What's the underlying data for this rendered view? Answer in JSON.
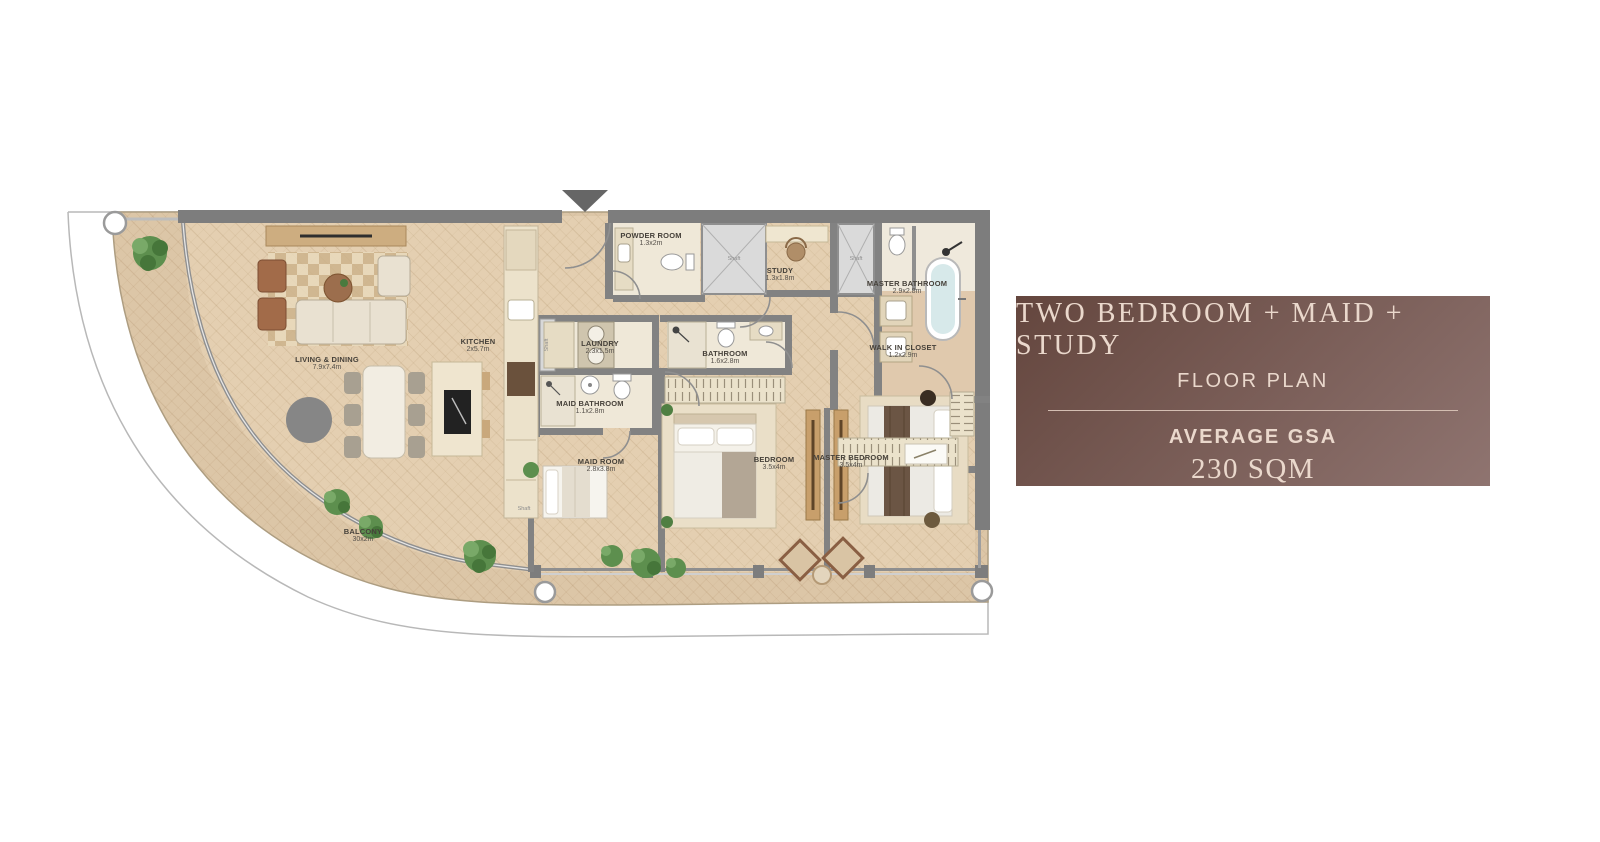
{
  "panel": {
    "title": "TWO BEDROOM + MAID + STUDY",
    "subtitle": "FLOOR PLAN",
    "area_label": "AVERAGE GSA",
    "area_value": "230 SQM",
    "bg_from": "#64463e",
    "bg_to": "#8f7470",
    "text_color": "#ead8cc"
  },
  "rooms": [
    {
      "name": "LIVING & DINING",
      "dims": "7.9x7.4m"
    },
    {
      "name": "KITCHEN",
      "dims": "2x5.7m"
    },
    {
      "name": "POWDER ROOM",
      "dims": "1.3x2m"
    },
    {
      "name": "STUDY",
      "dims": "1.3x1.8m"
    },
    {
      "name": "MASTER BATHROOM",
      "dims": "2.9x2.8m"
    },
    {
      "name": "WALK IN CLOSET",
      "dims": "1.2x2.9m"
    },
    {
      "name": "LAUNDRY",
      "dims": "2.3x1.5m"
    },
    {
      "name": "MAID BATHROOM",
      "dims": "1.1x2.8m"
    },
    {
      "name": "MAID ROOM",
      "dims": "2.8x3.8m"
    },
    {
      "name": "BATHROOM",
      "dims": "1.6x2.8m"
    },
    {
      "name": "BEDROOM",
      "dims": "3.5x4m"
    },
    {
      "name": "MASTER BEDROOM",
      "dims": "3.5x4m"
    },
    {
      "name": "BALCONY",
      "dims": "30x2m"
    }
  ],
  "shaft_label": "Shaft",
  "colors": {
    "wall": "#7d7d7d",
    "floor": "#e4cfb1",
    "balcony_floor": "#dcc6a7",
    "bath_floor": "#efe8d8",
    "plant": "#5d8f4e"
  }
}
